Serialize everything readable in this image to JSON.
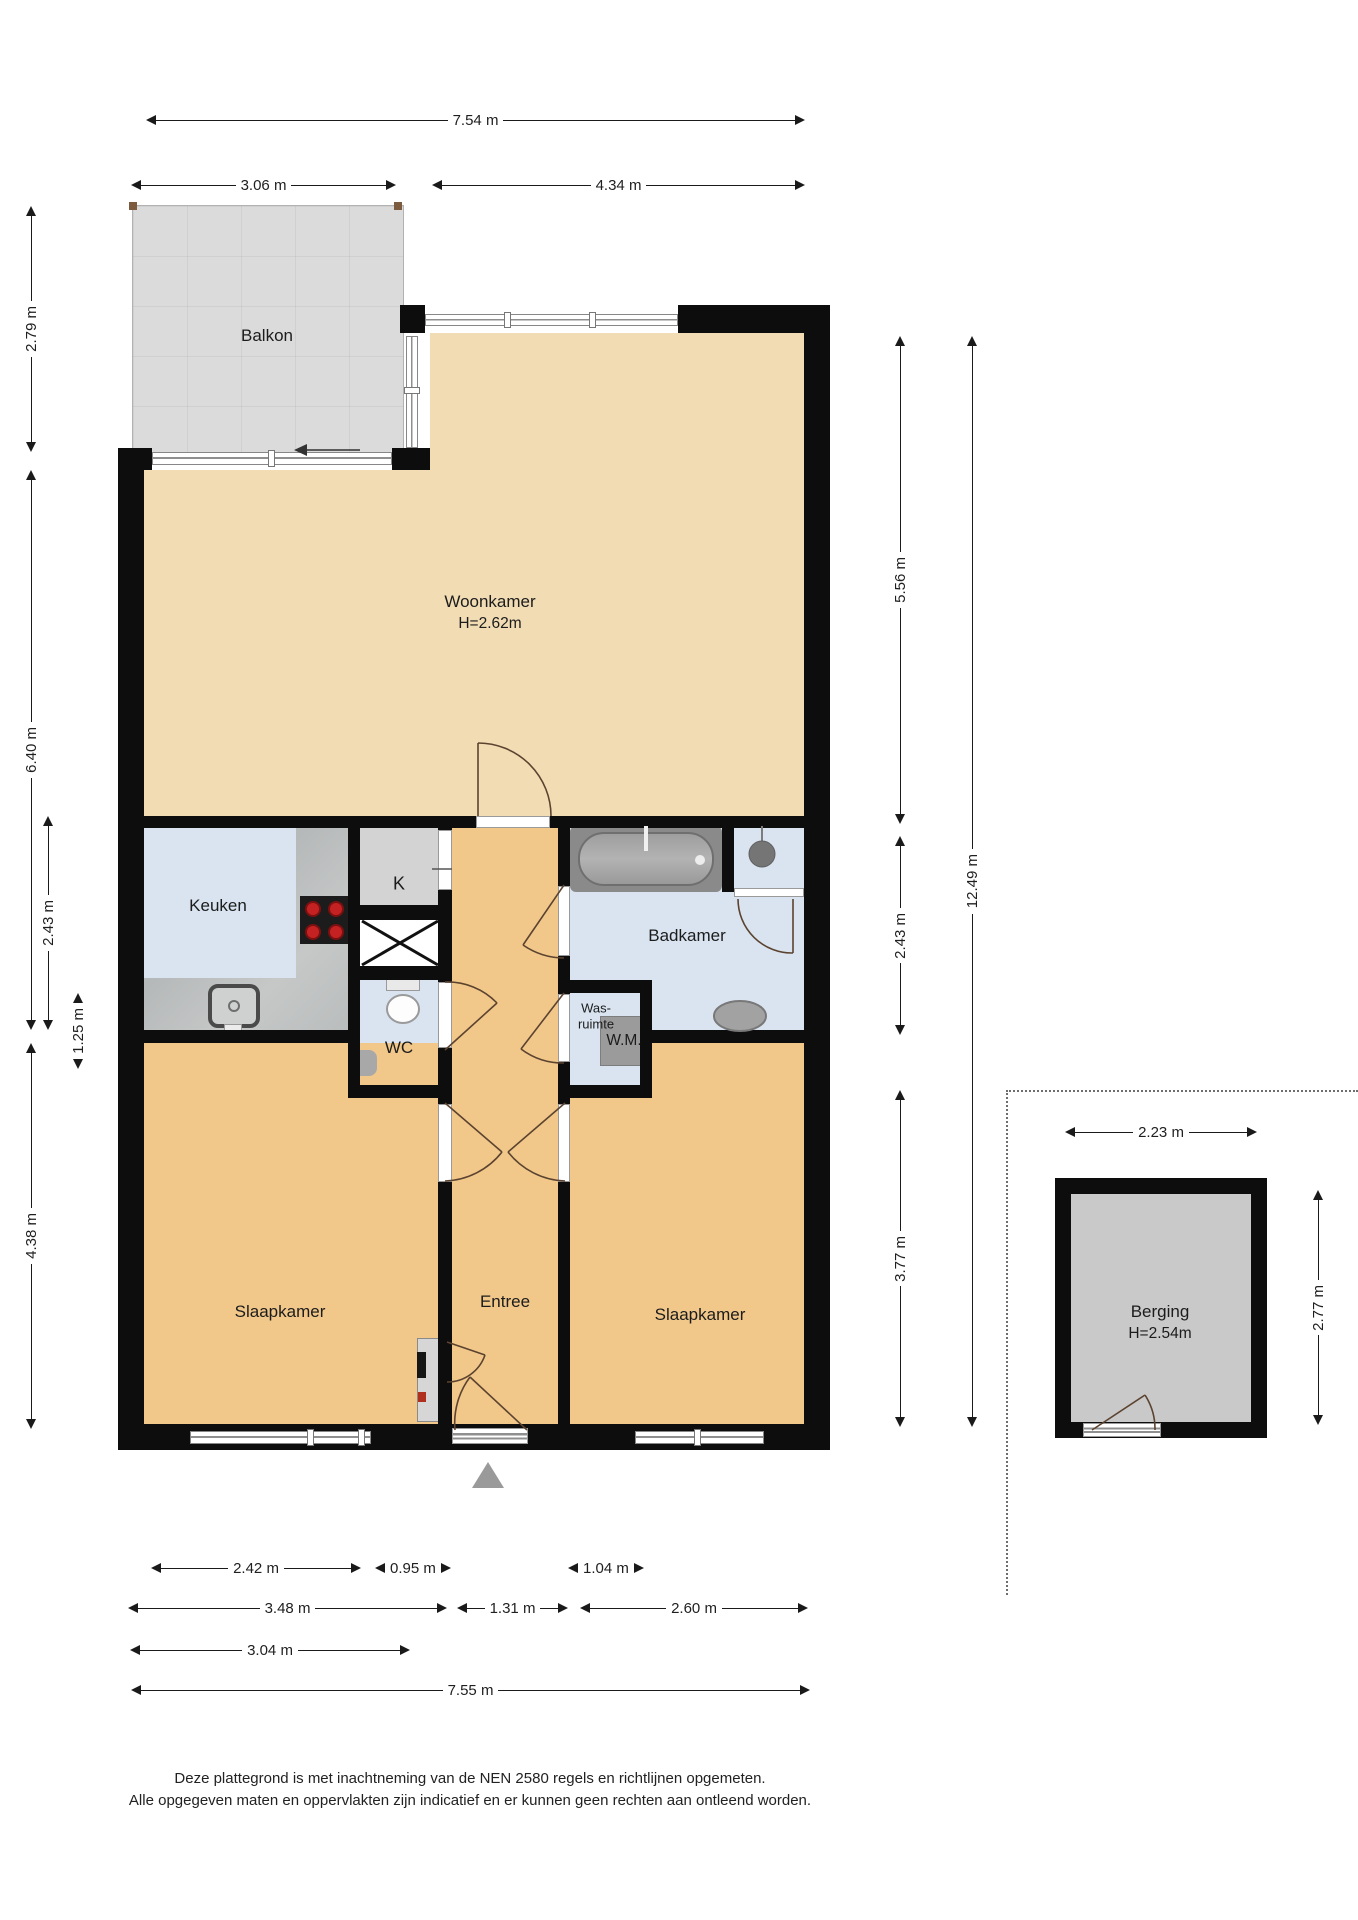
{
  "title": "Plattegrond appartement",
  "rooms": {
    "balkon": "Balkon",
    "woonkamer": "Woonkamer",
    "woonkamer_height": "H=2.62m",
    "keuken": "Keuken",
    "kast": "K",
    "badkamer": "Badkamer",
    "wasruimte_line1": "Was-",
    "wasruimte_line2": "ruimte",
    "wasmachine": "W.M.",
    "wc": "WC",
    "slaapkamer_links": "Slaapkamer",
    "entree": "Entree",
    "slaapkamer_rechts": "Slaapkamer",
    "berging": "Berging",
    "berging_height": "H=2.54m"
  },
  "dimensions": {
    "top_overall": "7.54 m",
    "top_balkon": "3.06 m",
    "top_woonkamer": "4.34 m",
    "left_balkon": "2.79 m",
    "left_woonkamer_keuken": "6.40 m",
    "left_keuken": "2.43 m",
    "left_wc": "1.25 m",
    "left_slaapkamer": "4.38 m",
    "right_woonkamer": "5.56 m",
    "right_badkamer": "2.43 m",
    "right_slaapkamer": "3.77 m",
    "right_overall": "12.49 m",
    "berging_breedte": "2.23 m",
    "berging_diepte": "2.77 m",
    "bottom_slaapkamer_l_raam": "2.42 m",
    "bottom_entree_deur": "0.95 m",
    "bottom_slaapkamer_r_raam": "1.04 m",
    "bottom_slaapkamer_l": "3.48 m",
    "bottom_entree": "1.31 m",
    "bottom_slaapkamer_r": "2.60 m",
    "bottom_links": "3.04 m",
    "bottom_overall": "7.55 m"
  },
  "footer": {
    "line1": "Deze plattegrond is met inachtneming van de NEN 2580 regels en richtlijnen opgemeten.",
    "line2": "Alle opgegeven maten en oppervlakten zijn indicatief en er kunnen geen rechten aan ontleend worden."
  },
  "colors": {
    "wall": "#0d0d0d",
    "woonkamer_floor": "#f2dcb4",
    "slaapkamer_floor": "#f1c88a",
    "natte_ruimte_floor": "#d9e4f0",
    "kast_floor": "#d3d3d3",
    "berging_floor": "#c9c9c9",
    "balkon_floor": "#dbdbdb",
    "entrance_marker": "#9a9a9a"
  }
}
